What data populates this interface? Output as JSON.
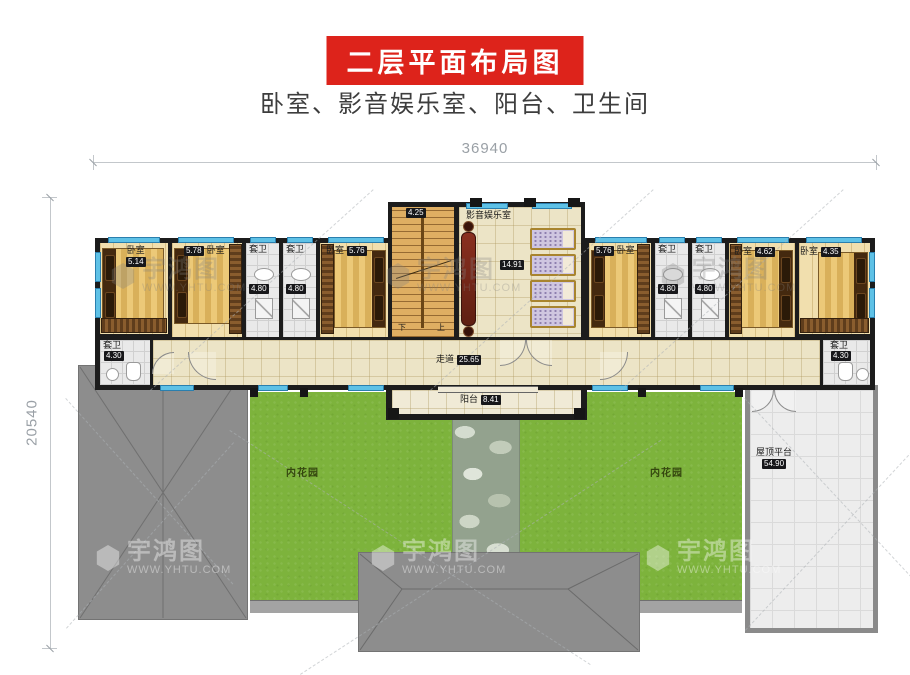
{
  "header": {
    "title": "二层平面布局图",
    "subtitle": "卧室、影音娱乐室、阳台、卫生间"
  },
  "dimensions": {
    "width_total": "36940",
    "height_total": "20540"
  },
  "watermark": {
    "brand": "宇鸿图",
    "site": "WWW.YHTU.COM"
  },
  "colors": {
    "accent_red": "#dd231b",
    "window_blue": "#5ec1e6",
    "garden_green": "#7db33c",
    "roof_gray": "#8d8d8d",
    "wall_black": "#1c1c1c"
  },
  "plan": {
    "bedrooms": [
      {
        "name": "卧室",
        "area": "5.14"
      },
      {
        "name": "卧室",
        "area": "5.78"
      },
      {
        "name": "卧室",
        "area": "5.76"
      },
      {
        "name": "卧室",
        "area": "5.76"
      },
      {
        "name": "卧室",
        "area": "4.62"
      },
      {
        "name": "卧室",
        "area": "4.35"
      }
    ],
    "suite_baths": [
      {
        "name": "套卫",
        "area": "4.80"
      },
      {
        "name": "套卫",
        "area": "4.80"
      },
      {
        "name": "套卫",
        "area": "4.80"
      },
      {
        "name": "套卫",
        "area": "4.80"
      }
    ],
    "corner_baths": [
      {
        "name": "套卫",
        "area": "4.30"
      },
      {
        "name": "套卫",
        "area": "4.30"
      }
    ],
    "entertainment": {
      "name": "影音娱乐室",
      "area": "14.91"
    },
    "stairwell": {
      "area": "4.25",
      "down": "下",
      "up": "上"
    },
    "corridor": {
      "name": "走道",
      "area": "25.65"
    },
    "balcony": {
      "name": "阳台",
      "area": "8.41"
    },
    "gardens": [
      {
        "name": "内花园"
      },
      {
        "name": "内花园"
      }
    ],
    "roof_terrace": {
      "name": "屋顶平台",
      "area": "54.90"
    }
  }
}
